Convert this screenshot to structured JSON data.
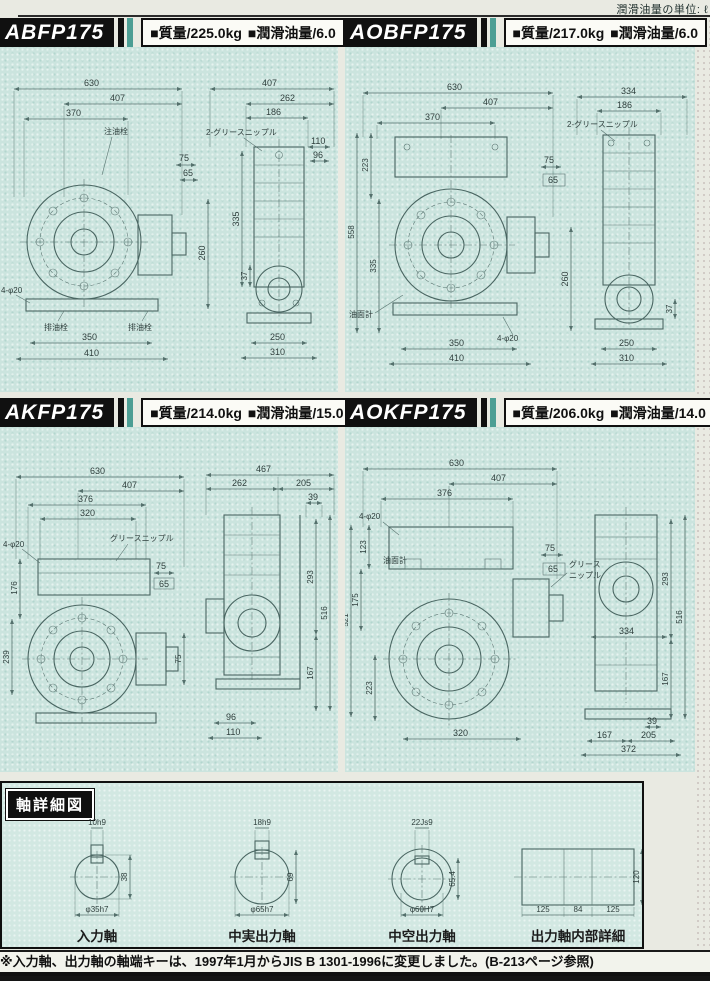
{
  "page": {
    "top_note": "潤滑油量の単位: ℓ",
    "footnote": "※入力軸、出力軸の軸端キーは、1997年1月からJIS B 1301-1996に変更しました。(B-213ページ参照)"
  },
  "models": [
    {
      "name": "ABFP175",
      "specs": {
        "mass": "■質量/225.0kg",
        "oil": "■潤滑油量/6.0"
      },
      "front": {
        "w1": "630",
        "w2": "407",
        "w3": "370",
        "plug": "注油栓",
        "r1": "75",
        "r2": "65",
        "rv": "260",
        "drain1": "排油栓",
        "drain2": "排油栓",
        "b1": "350",
        "b2": "410",
        "holes": "4-φ20"
      },
      "side": {
        "t1": "407",
        "t2": "262",
        "t3": "186",
        "grease": "2-グリースニップル",
        "r1": "110",
        "r2": "96",
        "l1": "335",
        "l2": "37",
        "b1": "250",
        "b2": "310"
      }
    },
    {
      "name": "AOBFP175",
      "specs": {
        "mass": "■質量/217.0kg",
        "oil": "■潤滑油量/6.0"
      },
      "front": {
        "w1": "630",
        "w2": "407",
        "w3": "370",
        "l1": "223",
        "l2": "558",
        "l3": "335",
        "r1": "75",
        "r2": "65",
        "rv": "260",
        "gauge": "油面計",
        "holes": "4-φ20",
        "b1": "350",
        "b2": "410"
      },
      "side": {
        "t1": "334",
        "t2": "186",
        "grease": "2-グリースニップル",
        "r1": "37",
        "b1": "250",
        "b2": "310"
      }
    },
    {
      "name": "AKFP175",
      "specs": {
        "mass": "■質量/214.0kg",
        "oil": "■潤滑油量/15.0"
      },
      "front": {
        "w1": "630",
        "w2": "407",
        "w3": "376",
        "w4": "320",
        "grease": "グリースニップル",
        "holes": "4-φ20",
        "l1": "176",
        "l2": "239",
        "r1": "75",
        "r2": "65",
        "rv": "75"
      },
      "side": {
        "t1": "467",
        "t2": "262",
        "t3": "205",
        "t4": "39",
        "r1": "293",
        "r2": "516",
        "r3": "167",
        "b1": "96",
        "b2": "110"
      }
    },
    {
      "name": "AOKFP175",
      "specs": {
        "mass": "■質量/206.0kg",
        "oil": "■潤滑油量/14.0"
      },
      "front": {
        "w1": "630",
        "w2": "407",
        "w3": "376",
        "holes": "4-φ20",
        "gauge": "油面計",
        "l1": "123",
        "l2": "175",
        "l3": "521",
        "l4": "223",
        "r1": "75",
        "r2": "65",
        "grease1": "グリース",
        "grease2": "ニップル",
        "b1": "320"
      },
      "side": {
        "m1": "334",
        "r1": "293",
        "r2": "516",
        "r3": "167",
        "b0": "39",
        "b1": "167",
        "b2": "205",
        "b3": "372"
      }
    }
  ],
  "shaft_section": {
    "title": "軸詳細図",
    "shafts": [
      {
        "label": "入力軸",
        "key": "10h9",
        "h": "38",
        "dia": "φ35h7"
      },
      {
        "label": "中実出力軸",
        "key": "18h9",
        "h": "69",
        "dia": "φ65h7"
      },
      {
        "label": "中空出力軸",
        "key": "22Js9",
        "h": "65.4",
        "dia": "φ60H7"
      },
      {
        "label": "出力軸内部詳細",
        "d1": "125",
        "d2": "84",
        "d3": "125",
        "h": "120"
      }
    ]
  },
  "colors": {
    "panel": "#cbe4de",
    "header": "#101010",
    "accent_bar": "#4d9e94",
    "line": "#54706c"
  }
}
